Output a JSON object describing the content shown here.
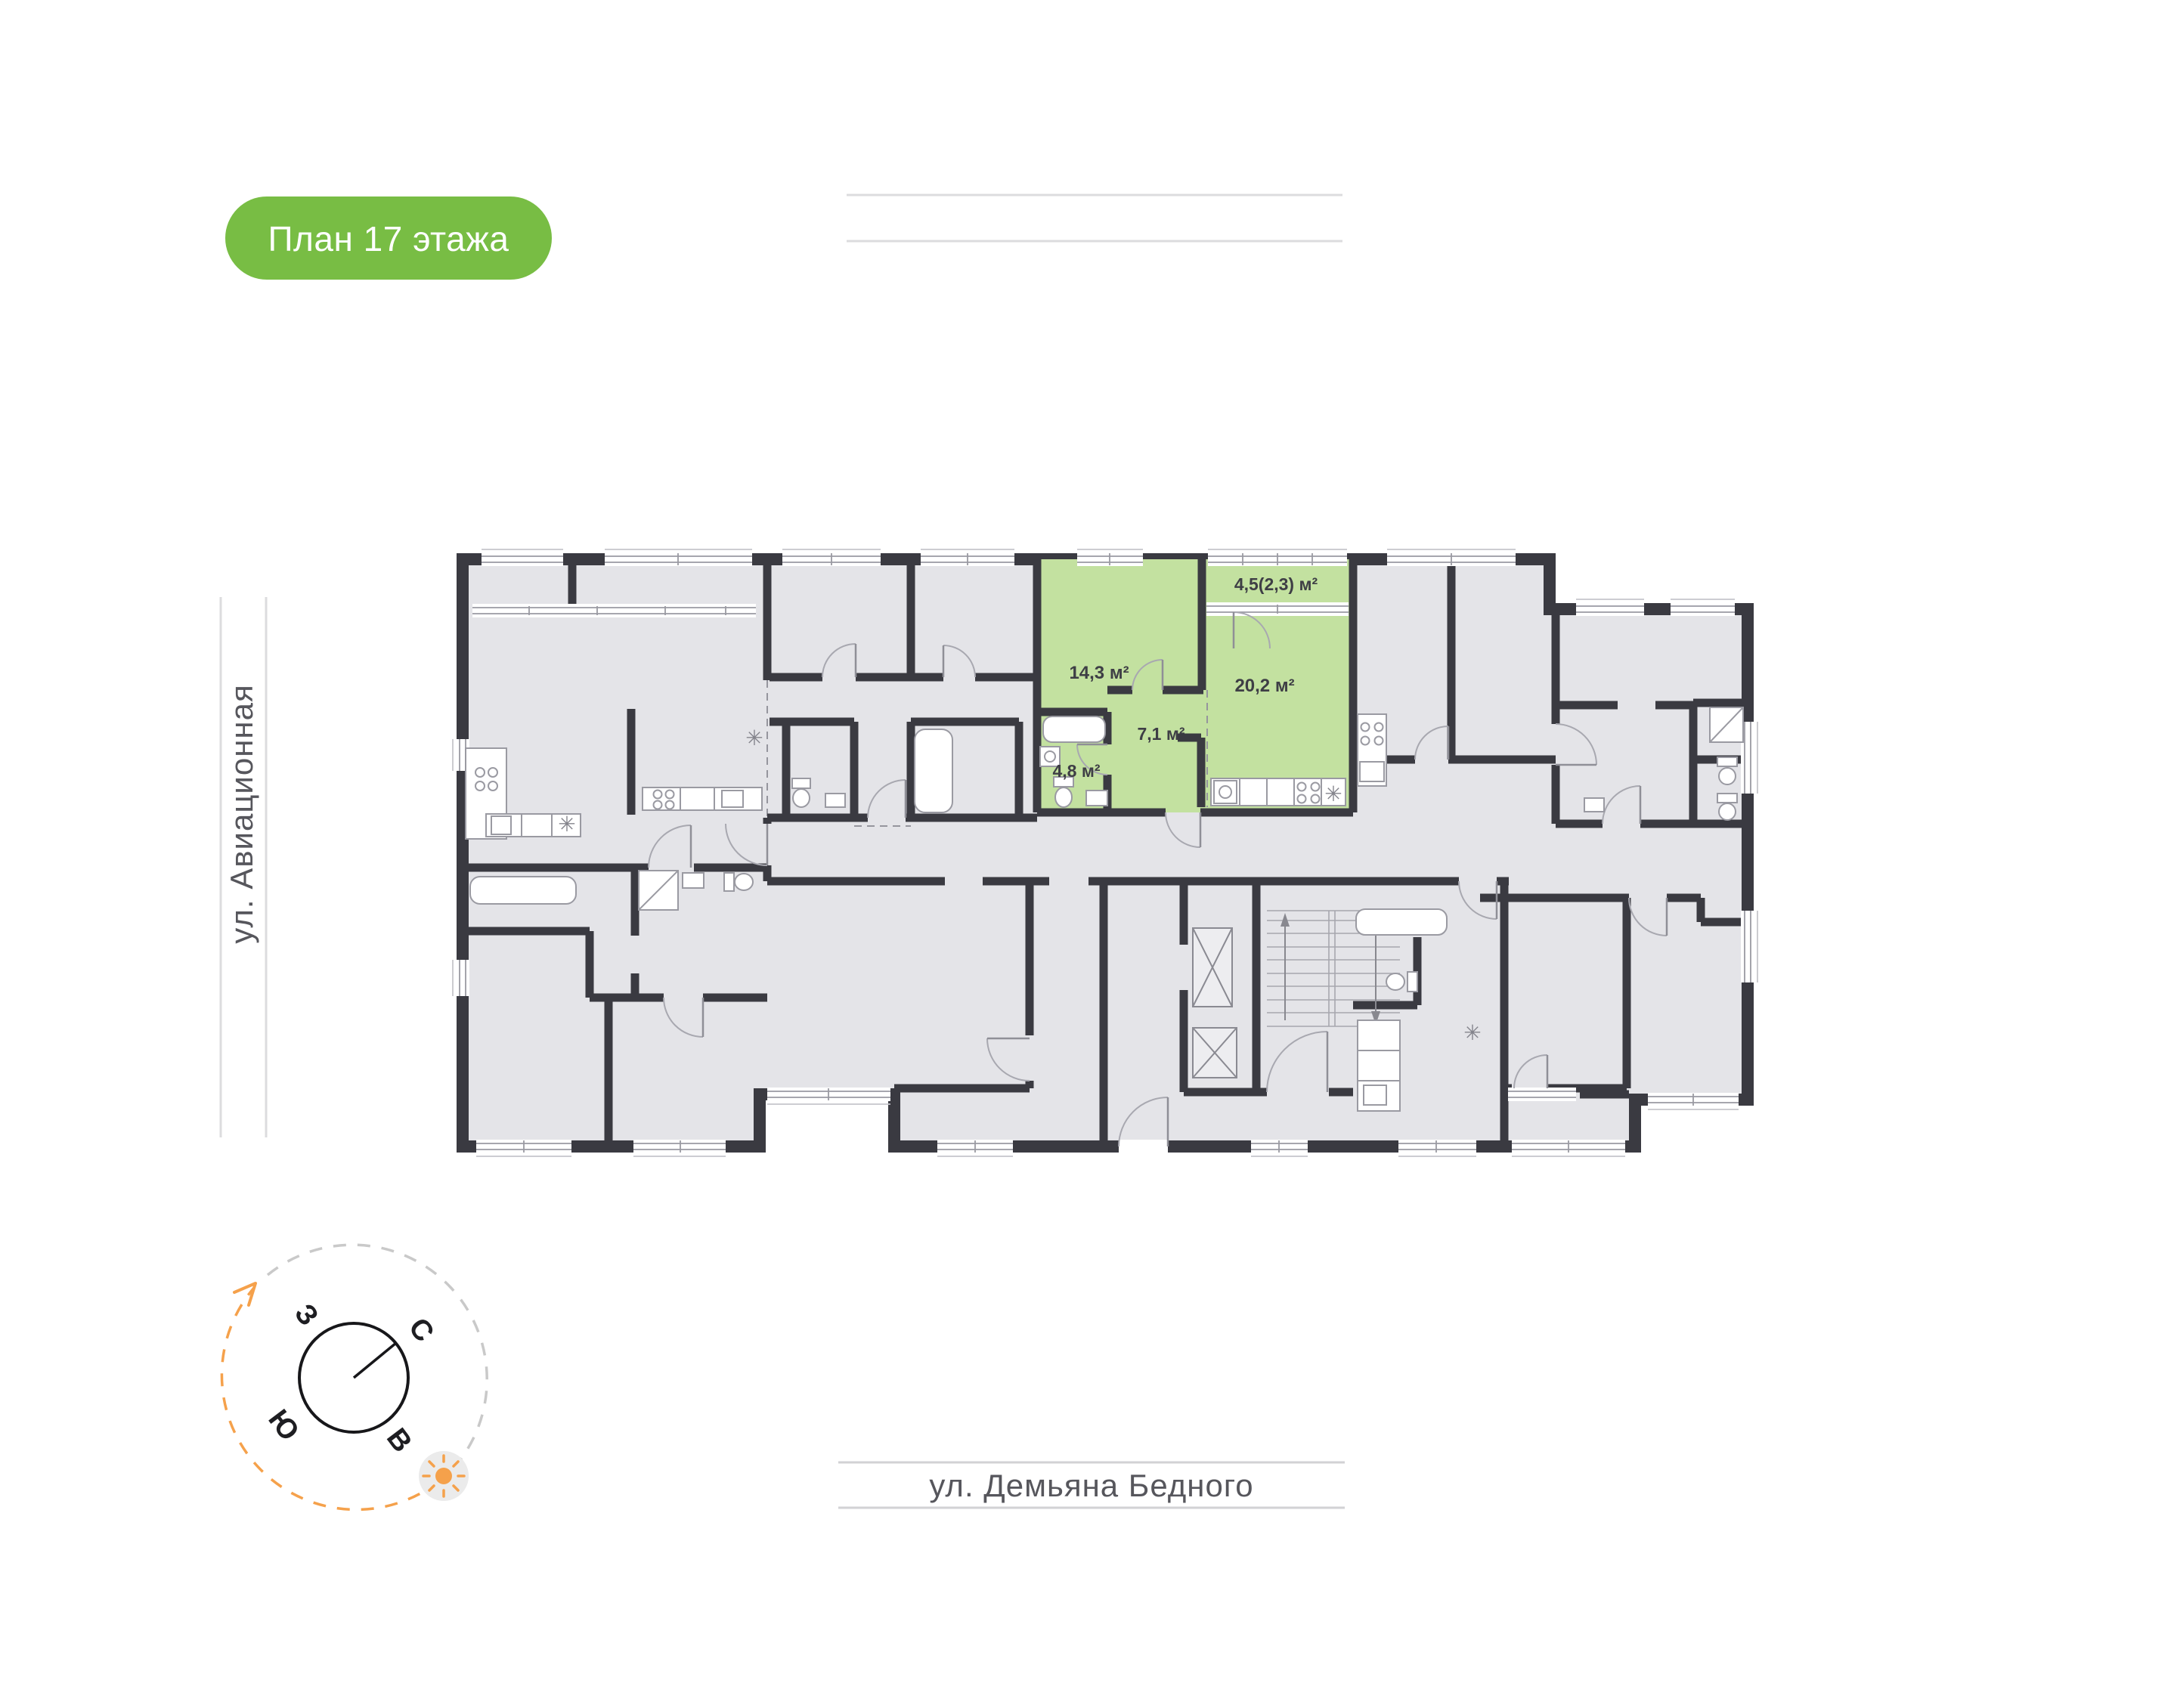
{
  "badge": {
    "label": "План 17 этажа",
    "bg_color": "#78bd44"
  },
  "streets": {
    "left": {
      "label": "ул. Авиационная"
    },
    "bottom": {
      "label": "ул. Демьяна Бедного"
    }
  },
  "compass": {
    "north": "С",
    "south": "Ю",
    "west": "З",
    "east": "В",
    "accent_color": "#f5a14b"
  },
  "plan": {
    "floor": "17",
    "wall_color": "#3a3a41",
    "floor_color": "#e4e4e8",
    "highlight_color": "#c3e1a0",
    "highlighted_apartment": {
      "rooms": [
        {
          "name": "bedroom",
          "label": "14,3 м²"
        },
        {
          "name": "balcony",
          "label": "4,5(2,3) м²"
        },
        {
          "name": "living-kitchen",
          "label": "20,2 м²"
        },
        {
          "name": "hallway",
          "label": "7,1 м²"
        },
        {
          "name": "bathroom",
          "label": "4,8 м²"
        }
      ]
    },
    "icons": {
      "appliance": "✳"
    }
  }
}
